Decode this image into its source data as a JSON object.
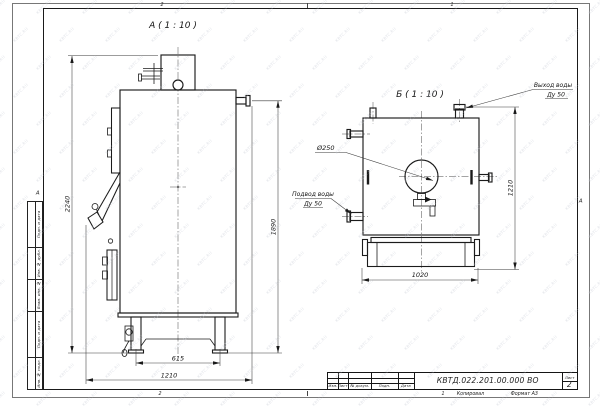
{
  "watermark": {
    "text": "КВТС.RU"
  },
  "sheet": {
    "zones_top": [
      "2",
      "1"
    ],
    "zones_bottom": [
      "2",
      "1"
    ],
    "fold_marks": {
      "left": "А",
      "right": "А"
    },
    "margin_columns": [
      "Подп. и дата",
      "Инв. № дубл.",
      "Взам. инв. №",
      "Подп. и дата",
      "Инв. № подл."
    ]
  },
  "title_block": {
    "doc_number": "КВТД.022.201.00.000 ВО",
    "sheet_label": "Лист",
    "sheet_number": "2",
    "revision_headers": [
      "Изм.",
      "Лист",
      "№ докум.",
      "Подп.",
      "Дата"
    ],
    "footer": {
      "zone": "1",
      "copy": "Копировал",
      "format": "Формат А3"
    }
  },
  "views": {
    "a": {
      "title": "А ( 1 : 10 )",
      "dims": {
        "total_height": "2240",
        "outlet_height": "1890",
        "base_width": "615",
        "overall_width": "1210"
      }
    },
    "b": {
      "title": "Б ( 1 : 10 )",
      "dims": {
        "base_width": "1020",
        "height": "1210",
        "flue_diameter": "Ø250"
      },
      "labels": {
        "outlet": {
          "line1": "Выход воды",
          "line2": "Ду 50"
        },
        "inlet": {
          "line1": "Подвод воды",
          "line2": "Ду 50"
        }
      }
    }
  }
}
